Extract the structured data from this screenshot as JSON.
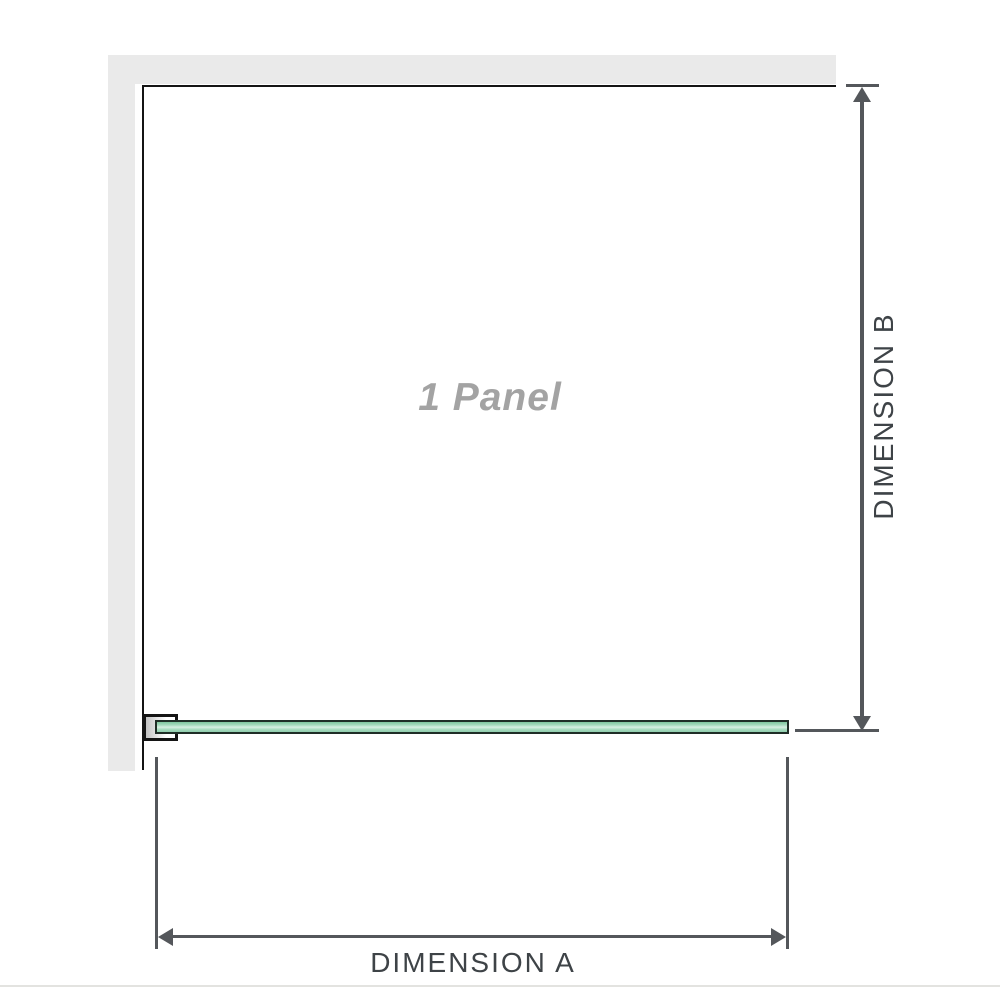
{
  "diagram": {
    "watermark_label": "1 Panel",
    "dimension_a": {
      "label": "DIMENSION A"
    },
    "dimension_b": {
      "label": "DIMENSION B"
    }
  },
  "colors": {
    "wall": "#eaeaea",
    "panel_outline": "#141414",
    "dimension_lines": "#54575b",
    "label_text": "#3e4347",
    "watermark_text": "#a3a3a3",
    "glass_fill": "#a6dabd",
    "glass_highlight": "#d7efe1",
    "glass_border": "#1f2d26",
    "bracket_fill": "#c3c3c3",
    "separator": "#e3e3e0"
  }
}
